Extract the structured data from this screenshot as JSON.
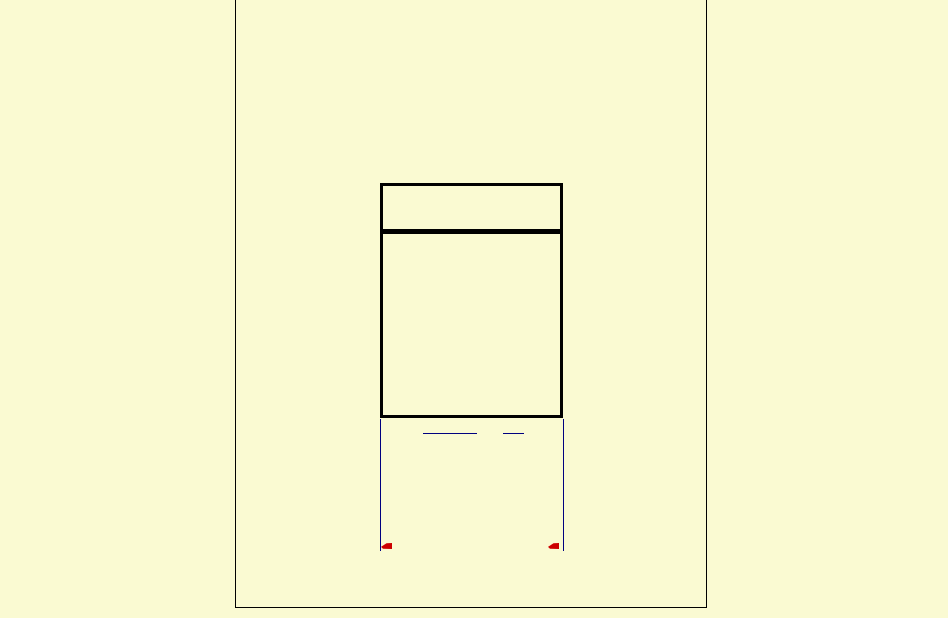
{
  "scene": {
    "description": "Blank cream-colored rendered page: tall thin-bordered frame (top edge off-screen), an empty two-row table with thick black borders, two navy hyperlink underline segments below the table, two navy vertical rules descending from the table's bottom corners, each ending in a small red left-pointing flag marker",
    "visible_text": ""
  },
  "colors": {
    "background": "#FAFAD2",
    "outline": "#000000",
    "link_blue": "#000080",
    "marker_red": "#CC0000"
  },
  "icons": {
    "red_flag_left": "small solid red left-pointing flag/wedge",
    "red_flag_right": "small solid red left-pointing flag/wedge"
  },
  "links": {
    "underline_segment_count": 2
  }
}
